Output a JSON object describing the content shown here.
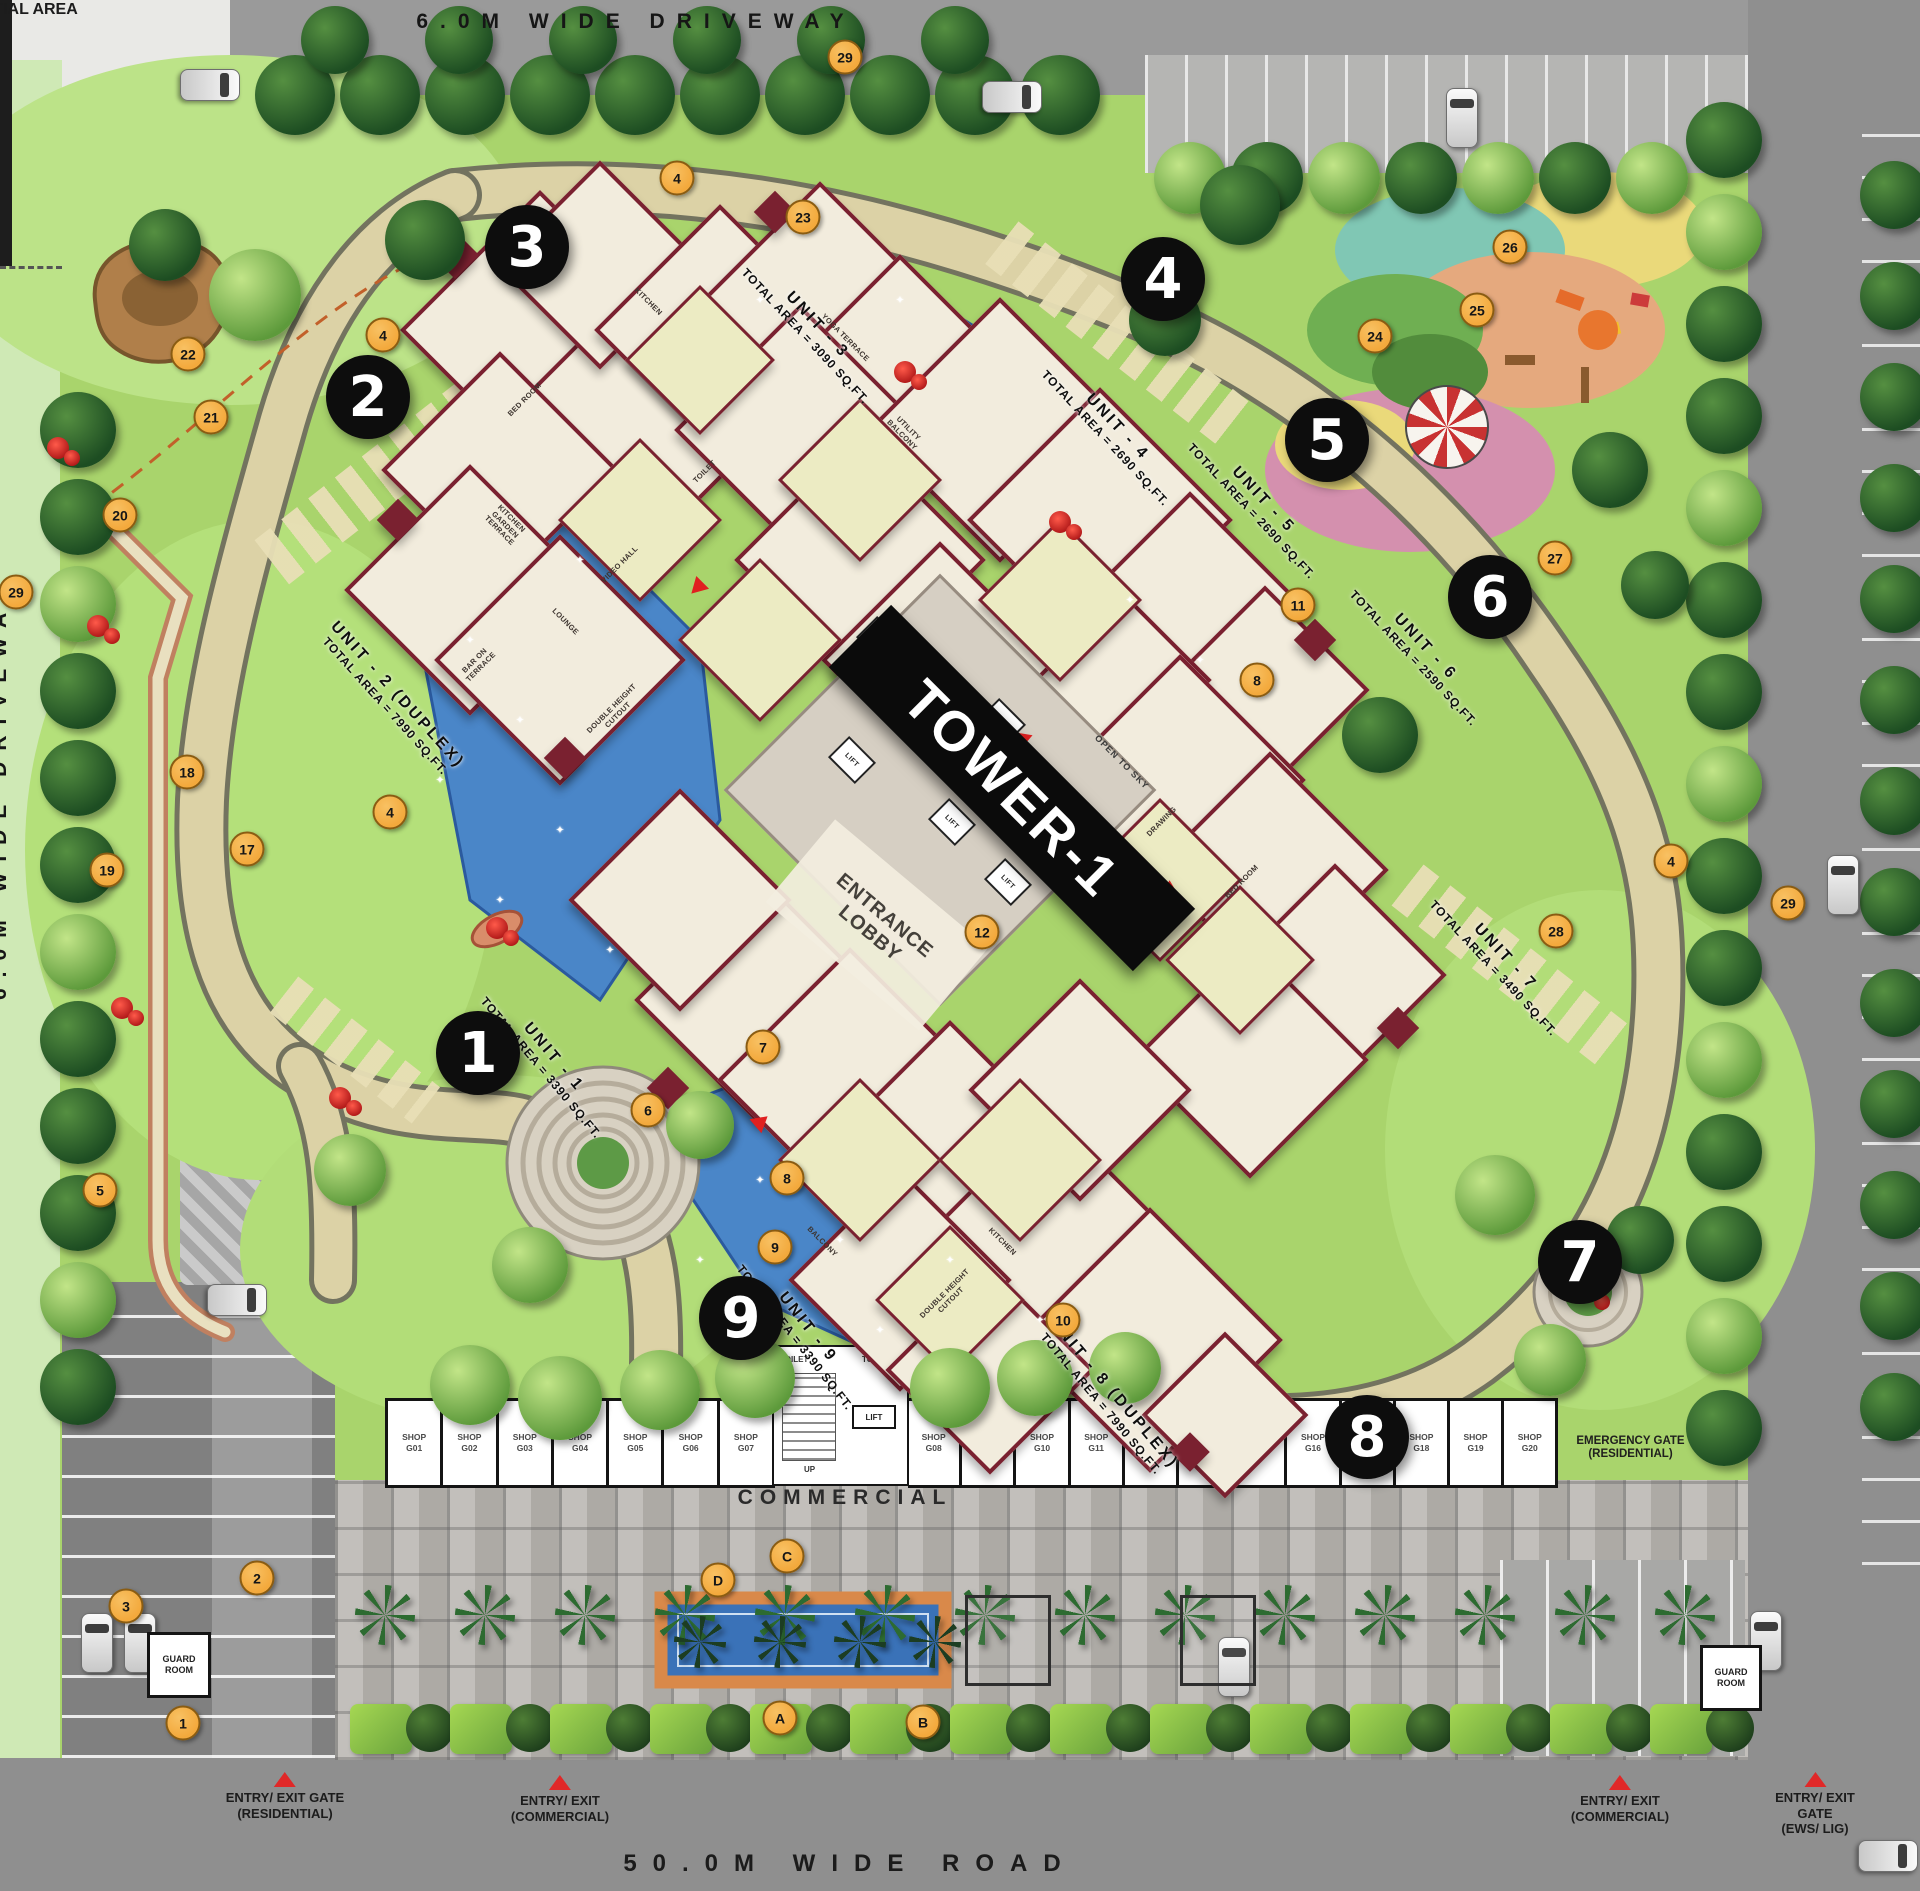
{
  "site": {
    "top_driveway": "6.0M WIDE DRIVEWAY",
    "right_driveway": "6.0M WIDE DRIVEWAY",
    "ews_area": "EWS/ LIG RESIDENTIAL AREA",
    "bottom_road": "50.0M WIDE ROAD",
    "tower_banner": "TOWER-1",
    "entrance_lobby": "ENTRANCE LOBBY",
    "commercial": "COMMERCIAL",
    "emergency_gate": "EMERGENCY GATE (RESIDENTIAL)",
    "guard_room": "GUARD ROOM"
  },
  "gates": [
    {
      "line1": "ENTRY/ EXIT GATE",
      "line2": "(RESIDENTIAL)",
      "x": 285,
      "y": 1772
    },
    {
      "line1": "ENTRY/ EXIT",
      "line2": "(COMMERCIAL)",
      "x": 560,
      "y": 1775
    },
    {
      "line1": "ENTRY/ EXIT",
      "line2": "(COMMERCIAL)",
      "x": 1620,
      "y": 1775
    },
    {
      "line1": "ENTRY/ EXIT GATE",
      "line2": "(EWS/ LIG)",
      "x": 1815,
      "y": 1772
    }
  ],
  "units": [
    {
      "name": "UNIT - 1",
      "area": "TOTAL AREA = 3390 SQ.FT.",
      "x": 548,
      "y": 1062,
      "rot": 50
    },
    {
      "name": "UNIT - 2 (DUPLEX)",
      "area": "TOTAL AREA = 7990 SQ.FT.",
      "x": 392,
      "y": 700,
      "rot": 48
    },
    {
      "name": "UNIT - 3",
      "area": "TOTAL AREA = 3090 SQ.FT.",
      "x": 812,
      "y": 330,
      "rot": 47
    },
    {
      "name": "UNIT - 4",
      "area": "TOTAL AREA = 2690 SQ.FT.",
      "x": 1112,
      "y": 432,
      "rot": 47
    },
    {
      "name": "UNIT - 5",
      "area": "TOTAL AREA = 2690 SQ.FT.",
      "x": 1258,
      "y": 505,
      "rot": 47
    },
    {
      "name": "UNIT - 6",
      "area": "TOTAL AREA = 2590 SQ.FT.",
      "x": 1420,
      "y": 652,
      "rot": 47
    },
    {
      "name": "UNIT - 7",
      "area": "TOTAL AREA = 3490 SQ.FT.",
      "x": 1500,
      "y": 962,
      "rot": 47
    },
    {
      "name": "UNIT - 8 (DUPLEX)",
      "area": "TOTAL AREA = 7990 SQ.FT.",
      "x": 1108,
      "y": 1398,
      "rot": 50
    },
    {
      "name": "UNIT - 9",
      "area": "TOTAL AREA = 3390 SQ.FT.",
      "x": 802,
      "y": 1332,
      "rot": 52
    }
  ],
  "tower_markers": [
    {
      "n": "1",
      "x": 478,
      "y": 1053
    },
    {
      "n": "2",
      "x": 368,
      "y": 397
    },
    {
      "n": "3",
      "x": 527,
      "y": 247
    },
    {
      "n": "4",
      "x": 1163,
      "y": 279
    },
    {
      "n": "5",
      "x": 1327,
      "y": 440
    },
    {
      "n": "6",
      "x": 1490,
      "y": 597
    },
    {
      "n": "7",
      "x": 1580,
      "y": 1262
    },
    {
      "n": "8",
      "x": 1367,
      "y": 1437
    },
    {
      "n": "9",
      "x": 741,
      "y": 1318
    }
  ],
  "legend_markers": [
    {
      "t": "29",
      "x": 845,
      "y": 57
    },
    {
      "t": "4",
      "x": 677,
      "y": 178
    },
    {
      "t": "23",
      "x": 803,
      "y": 217
    },
    {
      "t": "4",
      "x": 383,
      "y": 335
    },
    {
      "t": "22",
      "x": 188,
      "y": 354
    },
    {
      "t": "21",
      "x": 211,
      "y": 417
    },
    {
      "t": "20",
      "x": 120,
      "y": 515
    },
    {
      "t": "29",
      "x": 16,
      "y": 592
    },
    {
      "t": "26",
      "x": 1510,
      "y": 247
    },
    {
      "t": "25",
      "x": 1477,
      "y": 310
    },
    {
      "t": "24",
      "x": 1375,
      "y": 336
    },
    {
      "t": "27",
      "x": 1555,
      "y": 558
    },
    {
      "t": "11",
      "x": 1298,
      "y": 605
    },
    {
      "t": "8",
      "x": 1257,
      "y": 680
    },
    {
      "t": "18",
      "x": 187,
      "y": 772
    },
    {
      "t": "4",
      "x": 390,
      "y": 812
    },
    {
      "t": "17",
      "x": 247,
      "y": 849
    },
    {
      "t": "4",
      "x": 1671,
      "y": 861
    },
    {
      "t": "19",
      "x": 107,
      "y": 870
    },
    {
      "t": "29",
      "x": 1788,
      "y": 903
    },
    {
      "t": "28",
      "x": 1556,
      "y": 931
    },
    {
      "t": "12",
      "x": 982,
      "y": 932
    },
    {
      "t": "7",
      "x": 763,
      "y": 1047
    },
    {
      "t": "6",
      "x": 648,
      "y": 1110
    },
    {
      "t": "8",
      "x": 787,
      "y": 1178
    },
    {
      "t": "5",
      "x": 100,
      "y": 1190
    },
    {
      "t": "9",
      "x": 775,
      "y": 1247
    },
    {
      "t": "10",
      "x": 1063,
      "y": 1320
    },
    {
      "t": "2",
      "x": 257,
      "y": 1578
    },
    {
      "t": "3",
      "x": 126,
      "y": 1606
    },
    {
      "t": "1",
      "x": 183,
      "y": 1723
    },
    {
      "t": "C",
      "x": 787,
      "y": 1556
    },
    {
      "t": "D",
      "x": 718,
      "y": 1580
    },
    {
      "t": "A",
      "x": 780,
      "y": 1718
    },
    {
      "t": "B",
      "x": 923,
      "y": 1722
    }
  ],
  "commercial_block": {
    "shops_left": [
      "SHOP G01",
      "SHOP G02",
      "SHOP G03",
      "SHOP G04",
      "SHOP G05",
      "SHOP G06",
      "SHOP G07"
    ],
    "shops_right": [
      "SHOP G08",
      "SHOP G09",
      "SHOP G10",
      "SHOP G11",
      "SHOP G12",
      "SHOP G14",
      "SHOP G15",
      "SHOP G16",
      "",
      "SHOP G18",
      "SHOP G19",
      "SHOP G20"
    ],
    "stair": {
      "toilet1": "TOILET",
      "toilet2": "TOILET",
      "lift": "LIFT",
      "up": "UP"
    }
  },
  "tower": {
    "lift": "LIFT",
    "open_to_sky": "OPEN TO SKY",
    "room_labels": [
      "BED ROOM",
      "KITCHEN",
      "TOILET",
      "YOGA TERRACE",
      "UTILITY BALCONY",
      "BAR ON TERRACE",
      "KITCHEN GARDEN TERRACE",
      "LOUNGE",
      "VIDEO HALL",
      "BALCONY",
      "DRAWING",
      "DOUBLE HEIGHT CUTOUT",
      "ENT. FOYER",
      "BED ROOM",
      "KITCHEN",
      "DOUBLE HEIGHT CUTOUT"
    ]
  },
  "colors": {
    "marker_orange": "#F3A93C",
    "marker_black": "#0D0D0D",
    "wall_maroon": "#7A2130",
    "pool_blue": "#4A86C8",
    "lawn_green": "#A9D46C",
    "road_gray": "#8F8F8F",
    "accent_red": "#E02828"
  }
}
